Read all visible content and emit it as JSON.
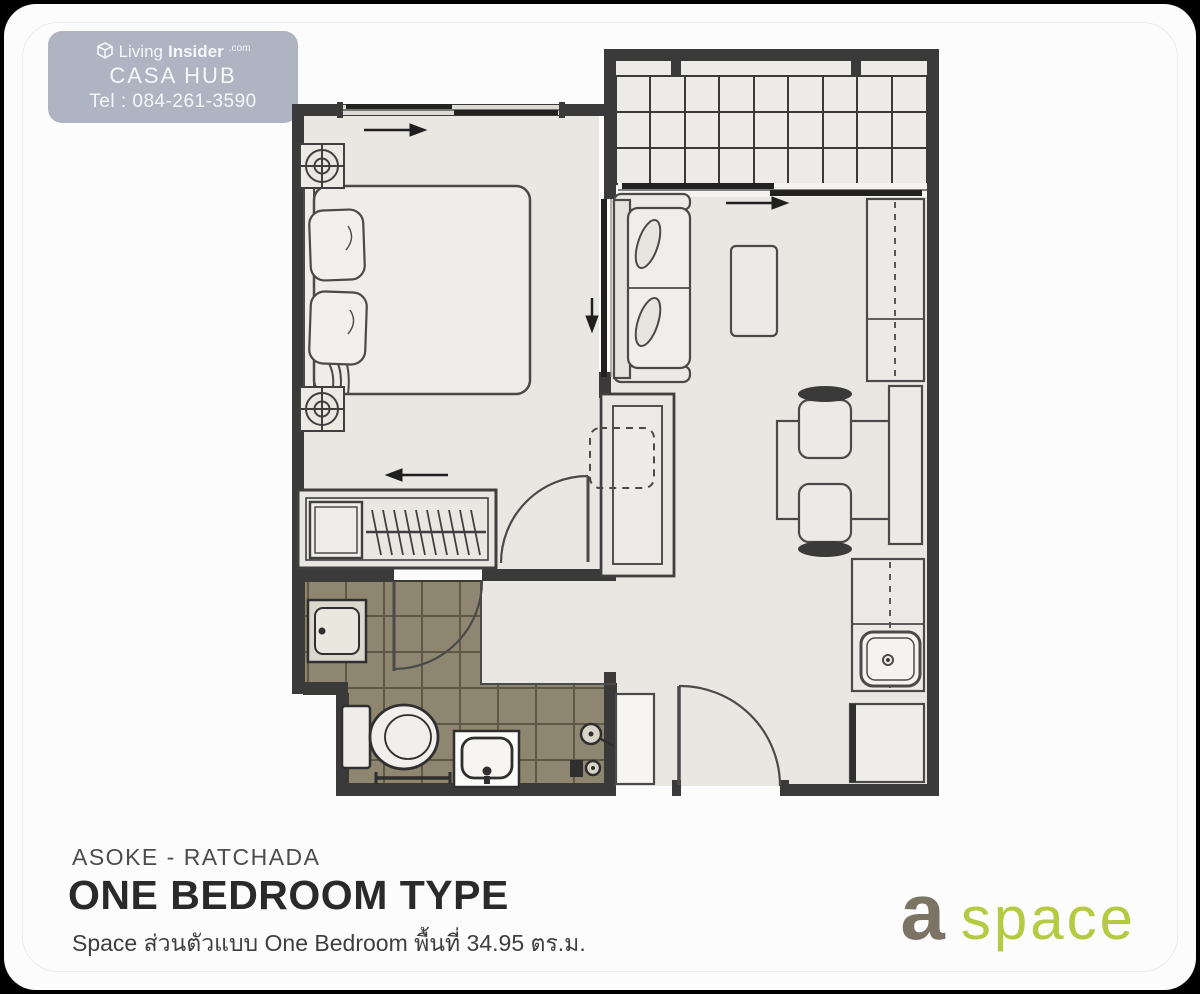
{
  "watermark": {
    "brand_prefix": "Living",
    "brand_suffix": "Insider",
    "brand_tld": ".com",
    "company": "CASA HUB",
    "phone": "Tel : 084-261-3590"
  },
  "footer": {
    "location": "ASOKE - RATCHADA",
    "title": "ONE BEDROOM TYPE",
    "subtitle": "Space  ส่วนตัวแบบ One Bedroom พื้นที่ 34.95 ตร.ม."
  },
  "brand_logo": {
    "first_word": "a",
    "second_word": "space",
    "first_color": "#7b7364",
    "second_color": "#b6ca41"
  },
  "palette": {
    "page_bg": "#000000",
    "card_bg": "#fcfcfc",
    "badge_bg": "#afb4c2",
    "wall": "#3a3a3a",
    "floor": "#e9e7e2",
    "balcony_floor": "#ecebe7",
    "bathroom_tile": "#8e8670"
  }
}
